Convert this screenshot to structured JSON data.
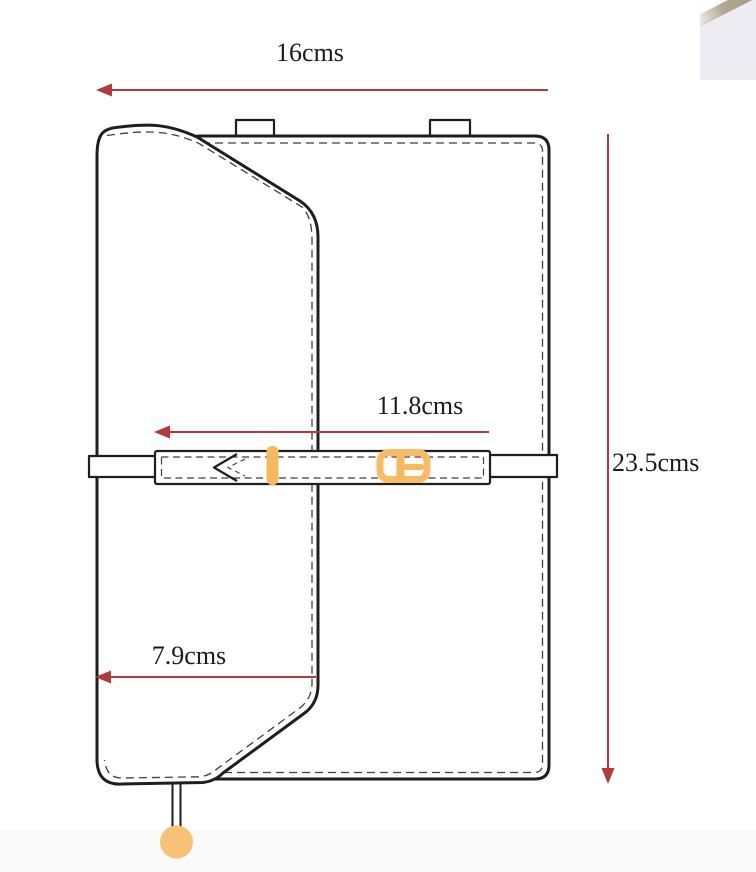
{
  "title": "Bag measurement technical drawing",
  "colors": {
    "background": "#ffffff",
    "line": "#1e1e20",
    "stitch": "#3f3f3f",
    "dimension_red": "#b23a3c",
    "hardware_orange": "#f5b95f",
    "buckle_orange": "#f8bc66",
    "ball_orange": "#f7c178",
    "footer_band": "#fafafa",
    "photo_base": "#ececf2",
    "photo_stripe": "#b3a890"
  },
  "dimensions": {
    "top_width": "16cms",
    "height": "23.5cms",
    "belt_length": "11.8cms",
    "flap_bottom_width": "7.9cms"
  }
}
